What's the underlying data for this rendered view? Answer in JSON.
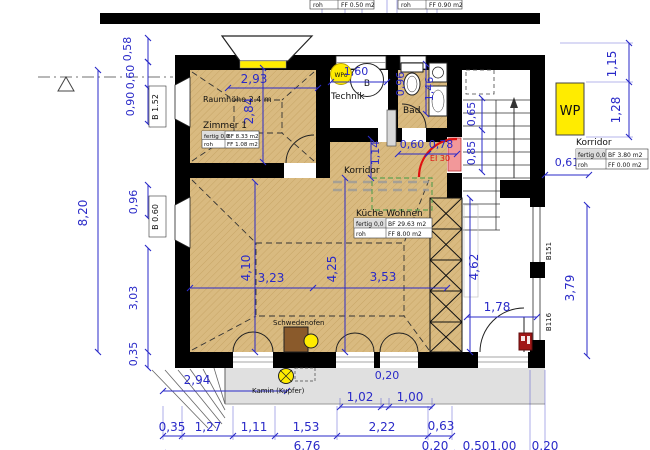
{
  "plan": {
    "rooms": {
      "zimmer1": {
        "label": "Zimmer 1",
        "note": "Raumhöhe 2.4 m",
        "info": {
          "r1c1": "fertig 0,0",
          "r1c2": "BF 8.33 m2",
          "r2c1": "roh",
          "r2c2": "FF 1.08 m2"
        }
      },
      "technik": {
        "label": "Technik",
        "boiler": "B",
        "wp_marker": "WPo"
      },
      "bad": {
        "label": "Bad"
      },
      "korridor": {
        "label": "Korridor"
      },
      "kueche": {
        "label": "Küche Wohnen",
        "info": {
          "r1c1": "fertig 0,0",
          "r1c2": "BF 29.63 m2",
          "r2c1": "roh",
          "r2c2": "FF 8.00 m2"
        }
      },
      "korridor_right": {
        "label": "Korridor",
        "info": {
          "r1c1": "fertig 0,0",
          "r1c2": "BF 3.80 m2",
          "r2c1": "roh",
          "r2c2": "FF 0.00 m2"
        }
      }
    },
    "annotations": {
      "wp_unit": "WP",
      "schwedenofen": "Schwedenofen",
      "kamin": "Kamin (Kupfer)",
      "fire_rating": "EI 30",
      "window_b152": "B 1.52",
      "window_b060": "B 0.60",
      "wall_b151": "B151",
      "wall_b116": "B116"
    },
    "partial_tables": {
      "t1": {
        "c1": "roh",
        "c2": "FF 0.50 m2"
      },
      "t2": {
        "c1": "roh",
        "c2": "FF 0.90 m2"
      }
    },
    "dims": {
      "v058": "0,58",
      "v060": "0,60",
      "v090": "0,90",
      "v820": "8,20",
      "v096l": "0,96",
      "v303": "3,03",
      "v035l": "0,35",
      "v293": "2,93",
      "v284": "2,84",
      "v160": "1,60",
      "v096b": "0,96",
      "v146": "1,46",
      "v114": "1,14",
      "v060d": "0,60",
      "v078": "0,78",
      "v065": "0,65",
      "v085": "0,85",
      "v410": "4,10",
      "v323": "3,23",
      "v425": "4,25",
      "v353": "3,53",
      "v462": "4,62",
      "v178": "1,78",
      "v379": "3,79",
      "v115": "1,15",
      "v128": "1,28",
      "v061": "0,61",
      "v294": "2,94",
      "v020a": "0,20",
      "v102": "1,02",
      "v100a": "1,00",
      "v035b": "0,35",
      "v127": "1,27",
      "v111": "1,11",
      "v153": "1,53",
      "v222": "2,22",
      "v063": "0,63",
      "v676": "6,76",
      "v020b": "0,20",
      "v050": "0,50",
      "v100b": "1,00",
      "v020c": "0,20"
    },
    "colors": {
      "dim": "#2a2ac8",
      "room": "#d9ba80",
      "highlight": "#ffec00",
      "fire_red": "#e01010",
      "door_pink": "#f2989a",
      "stove_brown": "#8a5a2b",
      "terrace": "#e0e0e0",
      "green": "#5fa050"
    }
  }
}
